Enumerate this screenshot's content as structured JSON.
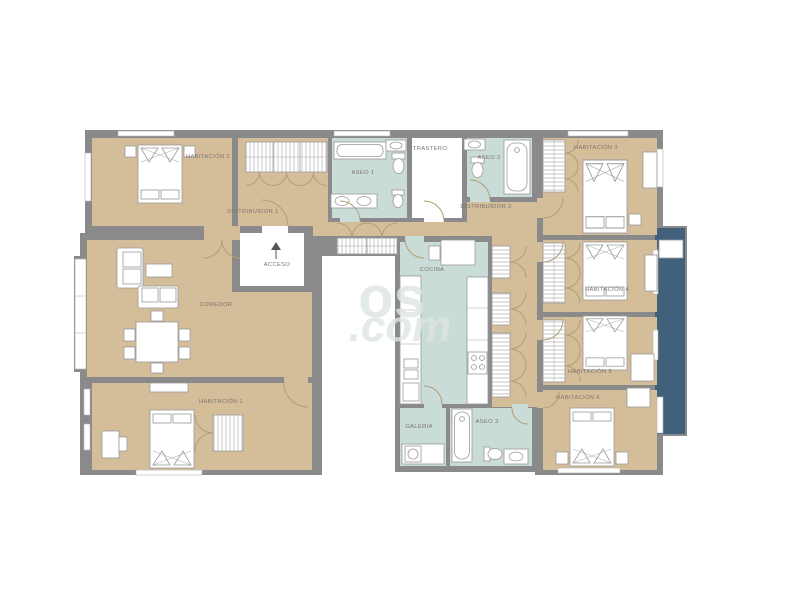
{
  "plan": {
    "watermark": {
      "part1": "os",
      "part2": ".com"
    },
    "access": {
      "label": "ACCESO"
    },
    "rooms": {
      "habitacion1": {
        "label": "HABITACIÓN 1",
        "floor": "bedroom"
      },
      "habitacion2": {
        "label": "HABITACIÓN 2",
        "floor": "bedroom"
      },
      "habitacion3": {
        "label": "HABITACIÓN 3",
        "floor": "bedroom"
      },
      "habitacion4": {
        "label": "HABITACIÓN 4",
        "floor": "bedroom"
      },
      "habitacion5": {
        "label": "HABITACIÓN 5",
        "floor": "bedroom"
      },
      "habitacion6": {
        "label": "HABITACIÓN 6",
        "floor": "bedroom"
      },
      "comedor": {
        "label": "COMEDOR",
        "floor": "living"
      },
      "cocina": {
        "label": "COCINA",
        "floor": "wet"
      },
      "aseo1": {
        "label": "ASEO 1",
        "floor": "wet"
      },
      "aseo2": {
        "label": "ASEO 2",
        "floor": "wet"
      },
      "aseo3": {
        "label": "ASEO 3",
        "floor": "wet"
      },
      "trastero": {
        "label": "TRASTERO",
        "floor": "storage"
      },
      "galeria": {
        "label": "GALERÍA",
        "floor": "wet"
      },
      "distribuidor1": {
        "label": "DISTRIBUIDOR 1",
        "floor": "hall"
      },
      "distribuidor2": {
        "label": "DISTRIBUIDOR 2",
        "floor": "hall"
      }
    },
    "colors": {
      "wall": "#8a8a8a",
      "room_floor": "#d4bd99",
      "wet_floor": "#c9dcd7",
      "balcony": "#41607b",
      "background": "#ffffff"
    }
  }
}
